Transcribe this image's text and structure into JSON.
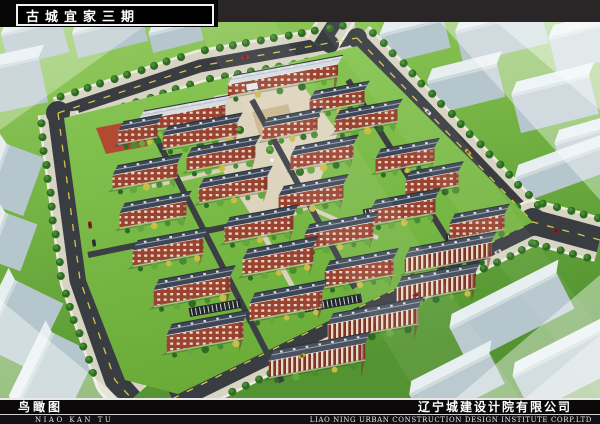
{
  "header": {
    "project_title": "古城宜家三期"
  },
  "footer": {
    "drawing_title_cn": "鸟瞰图",
    "drawing_title_en": "NIAO KAN TU",
    "company_cn": "辽宁城建设计院有限公司",
    "company_en": "LIAO NING URBAN CONSTRUCTION DESIGN INSTITUTE CORP.LTD"
  },
  "scene": {
    "palette": {
      "grass_light": "#9ccf66",
      "grass": "#74b343",
      "grass_dark": "#539331",
      "compound_grass_top": "#8ac856",
      "compound_grass": "#6aab38",
      "road": "#393d41",
      "road_dark": "#2e3134",
      "lane": "#3b3f43",
      "dash_yellow": "#e3d54e",
      "sidewalk": "#d8d4c4",
      "curb": "#edebdd",
      "tree_dark": "#2f6a25",
      "tree_mid": "#478c2e",
      "tree_light": "#63a83d",
      "shrub_yellow": "#c9bd45",
      "roof_dark": "#3d4654",
      "roof_edge": "#2b323c",
      "roof_ridge": "#97a2b0",
      "roof_light": "#d8dde2",
      "roof_light_ridge": "#b4bcc4",
      "roof_town": "#49525e",
      "brick": "#9a4330",
      "brick_dark": "#7c3424",
      "window": "#ead9c8",
      "eave": "#eeeeee",
      "block_side": "#b5c6cc",
      "block_top": "#e6eef0",
      "plaza": "#ddd4be",
      "plaza_accent": "#c8b287",
      "path": "#d9d2ba",
      "playground_red": "#b5402e",
      "pool_blue": "#4a7fc1",
      "parking": "#23272b",
      "haze": "#ffffff"
    },
    "roads": [
      {
        "pts": [
          [
            58,
            113
          ],
          [
            200,
            66
          ],
          [
            357,
            38
          ]
        ],
        "w": 13,
        "dash": true,
        "trees": true
      },
      {
        "pts": [
          [
            58,
            113
          ],
          [
            80,
            280
          ],
          [
            115,
            380
          ],
          [
            132,
            399
          ]
        ],
        "w": 21,
        "dash": true,
        "trees": true
      },
      {
        "pts": [
          [
            320,
            46
          ],
          [
            352,
            -4
          ]
        ],
        "w": 14,
        "dash": false,
        "trees": false
      },
      {
        "pts": [
          [
            357,
            38
          ],
          [
            533,
            222
          ]
        ],
        "w": 15,
        "dash": true,
        "trees": true
      },
      {
        "pts": [
          [
            600,
            240
          ],
          [
            533,
            222
          ],
          [
            172,
            399
          ]
        ],
        "w": 25,
        "dash": true,
        "trees": true
      }
    ],
    "junctions": [
      [
        58,
        113,
        12
      ],
      [
        357,
        38,
        10
      ],
      [
        533,
        222,
        14
      ],
      [
        330,
        44,
        9
      ]
    ],
    "context_blocks": [
      {
        "x": 4,
        "y": 26,
        "w": 62,
        "h": 34,
        "rot": -14
      },
      {
        "x": 74,
        "y": 24,
        "w": 72,
        "h": 26,
        "rot": -14
      },
      {
        "x": 150,
        "y": 27,
        "w": 52,
        "h": 20,
        "rot": -14
      },
      {
        "x": -8,
        "y": 62,
        "w": 52,
        "h": 46,
        "rot": -12
      },
      {
        "x": -16,
        "y": 160,
        "w": 62,
        "h": 40,
        "rot": -70
      },
      {
        "x": -12,
        "y": 225,
        "w": 50,
        "h": 34,
        "rot": -70
      },
      {
        "x": 382,
        "y": 26,
        "w": 66,
        "h": 30,
        "rot": -14
      },
      {
        "x": 458,
        "y": 20,
        "w": 88,
        "h": 34,
        "rot": -14
      },
      {
        "x": 552,
        "y": 30,
        "w": 58,
        "h": 36,
        "rot": -14
      },
      {
        "x": 430,
        "y": 72,
        "w": 72,
        "h": 34,
        "rot": -14
      },
      {
        "x": 515,
        "y": 84,
        "w": 80,
        "h": 40,
        "rot": -14
      },
      {
        "x": 558,
        "y": 132,
        "w": 72,
        "h": 36,
        "rot": -16
      },
      {
        "x": 516,
        "y": 160,
        "w": 100,
        "h": 26,
        "rot": -20
      },
      {
        "x": 452,
        "y": 298,
        "w": 120,
        "h": 40,
        "rot": -27
      },
      {
        "x": 516,
        "y": 348,
        "w": 112,
        "h": 42,
        "rot": -27
      },
      {
        "x": 412,
        "y": 372,
        "w": 90,
        "h": 34,
        "rot": -27
      },
      {
        "x": -14,
        "y": 298,
        "w": 74,
        "h": 54,
        "rot": -64
      },
      {
        "x": 14,
        "y": 356,
        "w": 84,
        "h": 50,
        "rot": -64
      }
    ],
    "compound": {
      "pts": [
        [
          64,
          118
        ],
        [
          357,
          46
        ],
        [
          533,
          222
        ],
        [
          178,
          394
        ],
        [
          125,
          380
        ],
        [
          86,
          280
        ]
      ]
    },
    "plaza": {
      "pts": [
        [
          214,
          96
        ],
        [
          300,
          82
        ],
        [
          338,
          132
        ],
        [
          310,
          208
        ],
        [
          262,
          232
        ],
        [
          222,
          170
        ]
      ],
      "accents": [
        [
          252,
          112
        ],
        [
          288,
          104
        ],
        [
          296,
          130
        ],
        [
          260,
          138
        ]
      ],
      "trees": [
        [
          240,
          130
        ],
        [
          270,
          150
        ],
        [
          292,
          120
        ],
        [
          255,
          185
        ],
        [
          300,
          172
        ],
        [
          232,
          156
        ]
      ],
      "paths": [
        {
          "pts": [
            [
              262,
              232
            ],
            [
              300,
              300
            ]
          ],
          "w": 5
        },
        {
          "pts": [
            [
              310,
              208
            ],
            [
              378,
              238
            ]
          ],
          "w": 4
        },
        {
          "pts": [
            [
              222,
              170
            ],
            [
              152,
              186
            ]
          ],
          "w": 4
        },
        {
          "pts": [
            [
              300,
              82
            ],
            [
              283,
              60
            ]
          ],
          "w": 4
        }
      ]
    },
    "playground": {
      "pts": [
        [
          96,
          128
        ],
        [
          138,
          120
        ],
        [
          148,
          146
        ],
        [
          106,
          154
        ]
      ],
      "pool": [
        120,
        143
      ]
    },
    "lanes": [
      {
        "pts": [
          [
            152,
            130
          ],
          [
            282,
            382
          ]
        ],
        "w": 6
      },
      {
        "pts": [
          [
            252,
            100
          ],
          [
            355,
            288
          ]
        ],
        "w": 6
      },
      {
        "pts": [
          [
            348,
            80
          ],
          [
            448,
            240
          ]
        ],
        "w": 6
      },
      {
        "pts": [
          [
            88,
            255
          ],
          [
            250,
            222
          ]
        ],
        "w": 6
      }
    ],
    "buildings": [
      {
        "x": 283,
        "y": 74,
        "len": 112,
        "t": "light"
      },
      {
        "x": 182,
        "y": 112,
        "len": 88,
        "t": "light"
      },
      {
        "x": 138,
        "y": 127,
        "len": 40,
        "t": "dark"
      },
      {
        "x": 337,
        "y": 95,
        "len": 56,
        "t": "dark"
      },
      {
        "x": 200,
        "y": 129,
        "len": 76,
        "t": "dark"
      },
      {
        "x": 290,
        "y": 122,
        "len": 56,
        "t": "dark"
      },
      {
        "x": 366,
        "y": 114,
        "len": 64,
        "t": "dark"
      },
      {
        "x": 145,
        "y": 169,
        "len": 66,
        "t": "dark"
      },
      {
        "x": 221,
        "y": 151,
        "len": 70,
        "t": "dark"
      },
      {
        "x": 322,
        "y": 150,
        "len": 64,
        "t": "dark"
      },
      {
        "x": 405,
        "y": 153,
        "len": 60,
        "t": "dark"
      },
      {
        "x": 432,
        "y": 176,
        "len": 54,
        "t": "dark"
      },
      {
        "x": 153,
        "y": 207,
        "len": 68,
        "t": "dark"
      },
      {
        "x": 233,
        "y": 182,
        "len": 70,
        "t": "dark"
      },
      {
        "x": 311,
        "y": 190,
        "len": 66,
        "t": "dark"
      },
      {
        "x": 403,
        "y": 204,
        "len": 66,
        "t": "dark"
      },
      {
        "x": 477,
        "y": 219,
        "len": 56,
        "t": "dark"
      },
      {
        "x": 168,
        "y": 244,
        "len": 72,
        "t": "dark"
      },
      {
        "x": 259,
        "y": 221,
        "len": 70,
        "t": "dark"
      },
      {
        "x": 339,
        "y": 228,
        "len": 70,
        "t": "dark"
      },
      {
        "x": 448,
        "y": 250,
        "len": 88,
        "t": "town"
      },
      {
        "x": 192,
        "y": 283,
        "len": 78,
        "t": "dark"
      },
      {
        "x": 278,
        "y": 253,
        "len": 72,
        "t": "dark"
      },
      {
        "x": 359,
        "y": 265,
        "len": 70,
        "t": "dark"
      },
      {
        "x": 436,
        "y": 280,
        "len": 80,
        "t": "town"
      },
      {
        "x": 205,
        "y": 328,
        "len": 78,
        "t": "dark"
      },
      {
        "x": 286,
        "y": 297,
        "len": 74,
        "t": "dark"
      },
      {
        "x": 373,
        "y": 316,
        "len": 92,
        "t": "town"
      },
      {
        "x": 317,
        "y": 352,
        "len": 98,
        "t": "town"
      }
    ],
    "parking": [
      {
        "x": 390,
        "y": 209,
        "len": 54
      },
      {
        "x": 333,
        "y": 303,
        "len": 58
      },
      {
        "x": 215,
        "y": 308,
        "len": 52
      },
      {
        "x": 468,
        "y": 235,
        "len": 44
      }
    ],
    "gate": {
      "x": 252,
      "y": 86
    },
    "cars": [
      {
        "x": 90,
        "y": 225,
        "a": 82,
        "c": "#8a1f1f"
      },
      {
        "x": 94,
        "y": 243,
        "a": 82,
        "c": "#303338"
      },
      {
        "x": 245,
        "y": 57,
        "a": -17,
        "c": "#a32222"
      },
      {
        "x": 428,
        "y": 112,
        "a": 46,
        "c": "#d8d8d8"
      },
      {
        "x": 468,
        "y": 152,
        "a": 46,
        "c": "#caa52a"
      },
      {
        "x": 498,
        "y": 252,
        "a": -27,
        "c": "#d0d0d0"
      },
      {
        "x": 416,
        "y": 295,
        "a": -27,
        "c": "#a32222"
      },
      {
        "x": 302,
        "y": 356,
        "a": -27,
        "c": "#caa52a"
      },
      {
        "x": 556,
        "y": 231,
        "a": 15,
        "c": "#8a1f1f"
      }
    ],
    "haze_polys": [
      {
        "pts": [
          [
            420,
            0
          ],
          [
            600,
            0
          ],
          [
            600,
            200
          ]
        ],
        "o": 0.38
      },
      {
        "pts": [
          [
            470,
            0
          ],
          [
            600,
            0
          ],
          [
            600,
            110
          ]
        ],
        "o": 0.38
      },
      {
        "pts": [
          [
            455,
            399
          ],
          [
            600,
            275
          ],
          [
            600,
            399
          ]
        ],
        "o": 0.42
      },
      {
        "pts": [
          [
            525,
            399
          ],
          [
            600,
            335
          ],
          [
            600,
            399
          ]
        ],
        "o": 0.38
      },
      {
        "pts": [
          [
            0,
            22
          ],
          [
            150,
            22
          ],
          [
            0,
            130
          ]
        ],
        "o": 0.3
      },
      {
        "pts": [
          [
            0,
            300
          ],
          [
            120,
            399
          ],
          [
            0,
            399
          ]
        ],
        "o": 0.4
      },
      {
        "pts": [
          [
            180,
            0
          ],
          [
            260,
            0
          ],
          [
            520,
            399
          ],
          [
            420,
            399
          ]
        ],
        "o": 0.07
      },
      {
        "pts": [
          [
            300,
            0
          ],
          [
            360,
            0
          ],
          [
            600,
            330
          ],
          [
            600,
            399
          ]
        ],
        "o": 0.06
      }
    ]
  }
}
